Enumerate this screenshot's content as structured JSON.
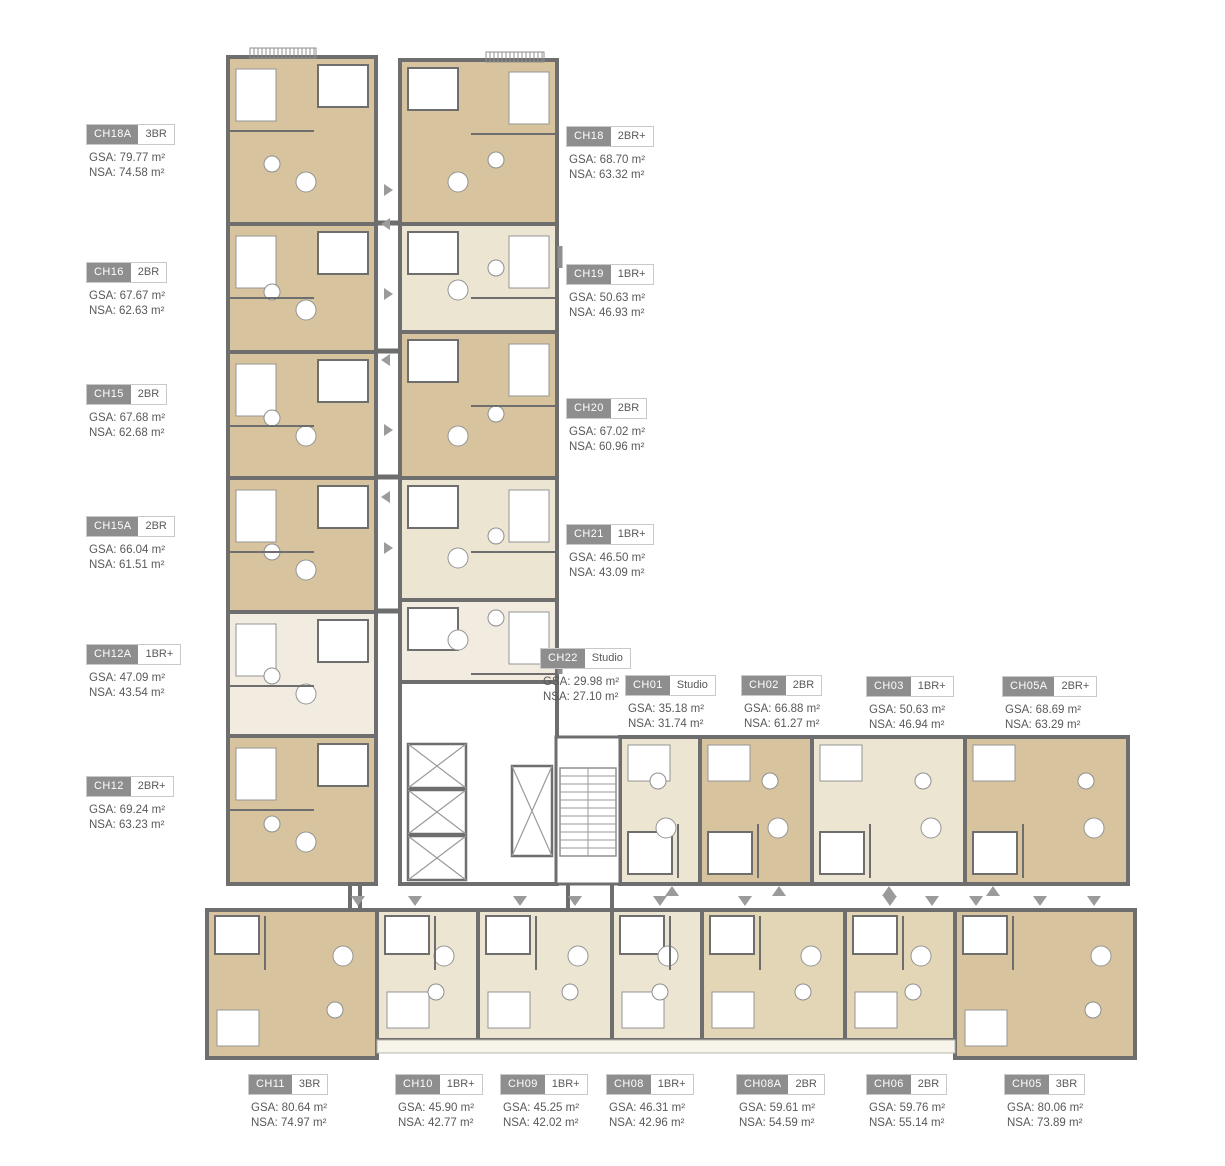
{
  "title": "Typical floor plan",
  "colors": {
    "wall": "#6e6e6e",
    "floor_tan": "#d7c49e",
    "floor_cream": "#ece5d2",
    "floor_pale": "#f1ecdf",
    "badge_gray": "#8e8e8e",
    "label_text": "#58595b",
    "arrow_gray": "#9b9b9b"
  },
  "units": [
    {
      "code": "CH18A",
      "type": "3BR",
      "gsa": "GSA: 79.77 m²",
      "nsa": "NSA: 74.58 m²"
    },
    {
      "code": "CH16",
      "type": "2BR",
      "gsa": "GSA: 67.67 m²",
      "nsa": "NSA: 62.63 m²"
    },
    {
      "code": "CH15",
      "type": "2BR",
      "gsa": "GSA: 67.68 m²",
      "nsa": "NSA: 62.68 m²"
    },
    {
      "code": "CH15A",
      "type": "2BR",
      "gsa": "GSA: 66.04 m²",
      "nsa": "NSA: 61.51 m²"
    },
    {
      "code": "CH12A",
      "type": "1BR+",
      "gsa": "GSA: 47.09 m²",
      "nsa": "NSA: 43.54 m²"
    },
    {
      "code": "CH12",
      "type": "2BR+",
      "gsa": "GSA: 69.24 m²",
      "nsa": "NSA: 63.23 m²"
    },
    {
      "code": "CH18",
      "type": "2BR+",
      "gsa": "GSA: 68.70 m²",
      "nsa": "NSA: 63.32 m²"
    },
    {
      "code": "CH19",
      "type": "1BR+",
      "gsa": "GSA: 50.63 m²",
      "nsa": "NSA: 46.93 m²"
    },
    {
      "code": "CH20",
      "type": "2BR",
      "gsa": "GSA: 67.02 m²",
      "nsa": "NSA: 60.96 m²"
    },
    {
      "code": "CH21",
      "type": "1BR+",
      "gsa": "GSA: 46.50 m²",
      "nsa": "NSA: 43.09 m²"
    },
    {
      "code": "CH22",
      "type": "Studio",
      "gsa": "GSA: 29.98 m²",
      "nsa": "NSA: 27.10 m²"
    },
    {
      "code": "CH01",
      "type": "Studio",
      "gsa": "GSA: 35.18 m²",
      "nsa": "NSA: 31.74 m²"
    },
    {
      "code": "CH02",
      "type": "2BR",
      "gsa": "GSA: 66.88 m²",
      "nsa": "NSA: 61.27 m²"
    },
    {
      "code": "CH03",
      "type": "1BR+",
      "gsa": "GSA: 50.63 m²",
      "nsa": "NSA: 46.94 m²"
    },
    {
      "code": "CH05A",
      "type": "2BR+",
      "gsa": "GSA: 68.69 m²",
      "nsa": "NSA: 63.29 m²"
    },
    {
      "code": "CH11",
      "type": "3BR",
      "gsa": "GSA: 80.64 m²",
      "nsa": "NSA: 74.97 m²"
    },
    {
      "code": "CH10",
      "type": "1BR+",
      "gsa": "GSA: 45.90 m²",
      "nsa": "NSA: 42.77 m²"
    },
    {
      "code": "CH09",
      "type": "1BR+",
      "gsa": "GSA: 45.25 m²",
      "nsa": "NSA: 42.02 m²"
    },
    {
      "code": "CH08",
      "type": "1BR+",
      "gsa": "GSA: 46.31 m²",
      "nsa": "NSA: 42.96 m²"
    },
    {
      "code": "CH08A",
      "type": "2BR",
      "gsa": "GSA: 59.61 m²",
      "nsa": "NSA: 54.59 m²"
    },
    {
      "code": "CH06",
      "type": "2BR",
      "gsa": "GSA: 59.76 m²",
      "nsa": "NSA: 55.14 m²"
    },
    {
      "code": "CH05",
      "type": "3BR",
      "gsa": "GSA: 80.06 m²",
      "nsa": "NSA: 73.89 m²"
    }
  ]
}
